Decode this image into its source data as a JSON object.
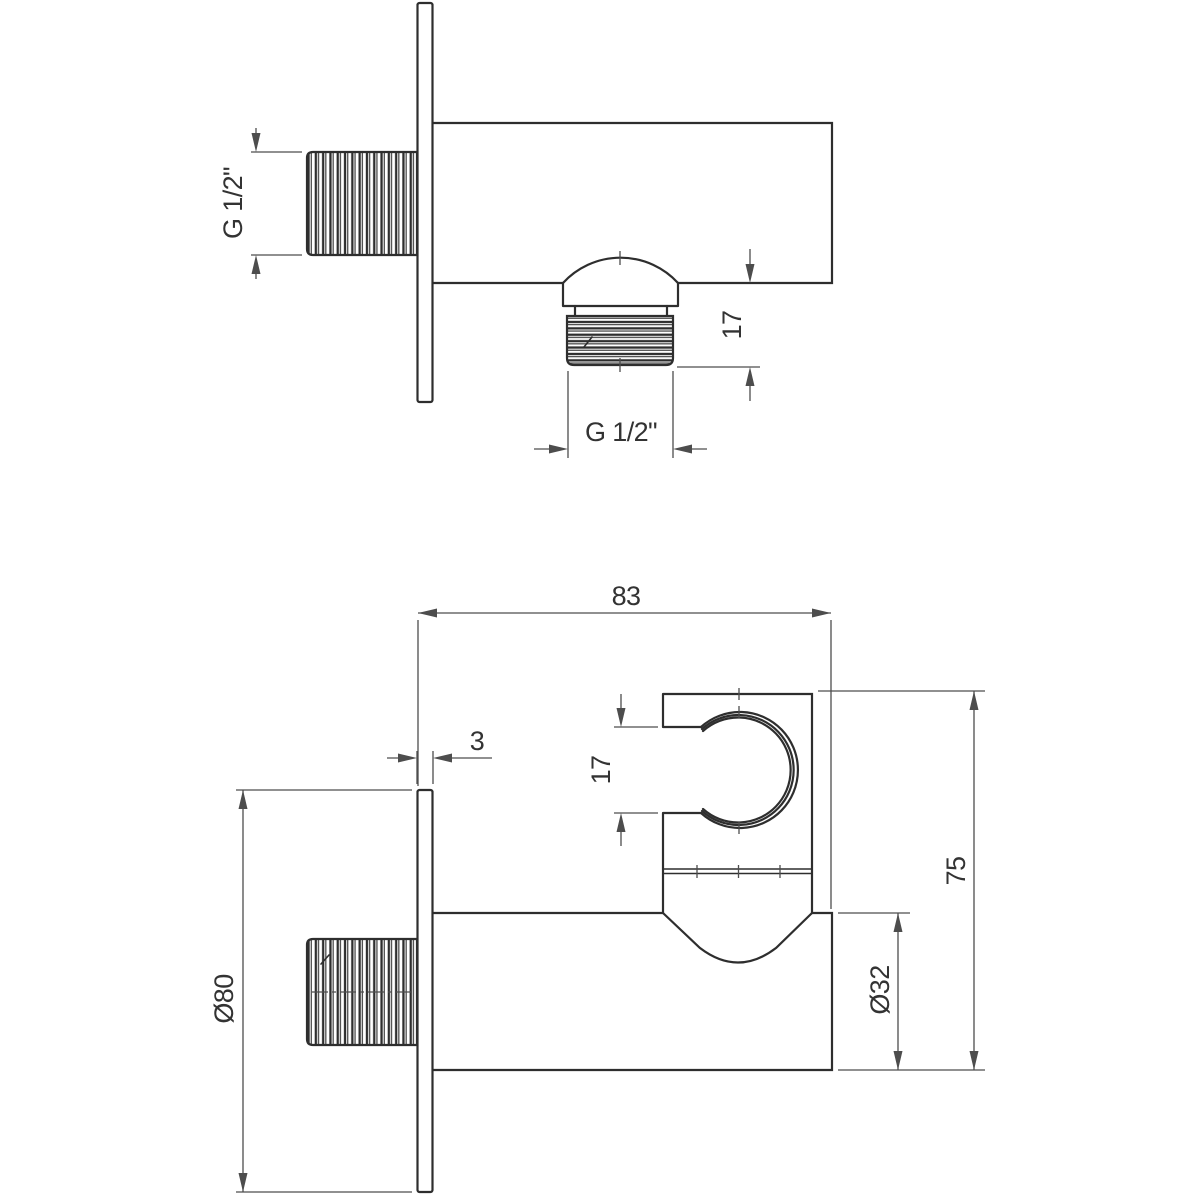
{
  "drawing": {
    "kind": "technical-dimension-drawing",
    "background": "#ffffff",
    "colors": {
      "object_line": "#2e2e2e",
      "dim_line": "#4d4d4d",
      "text": "#333333"
    },
    "top_view": {
      "labels": {
        "inlet_thread": "G 1/2\"",
        "outlet_height": "17",
        "outlet_thread": "G 1/2\""
      }
    },
    "bottom_view": {
      "labels": {
        "depth": "83",
        "plate_thickness": "3",
        "holder_opening": "17",
        "overall_height": "75",
        "body_diameter": "Ø32",
        "plate_diameter": "Ø80"
      }
    }
  }
}
